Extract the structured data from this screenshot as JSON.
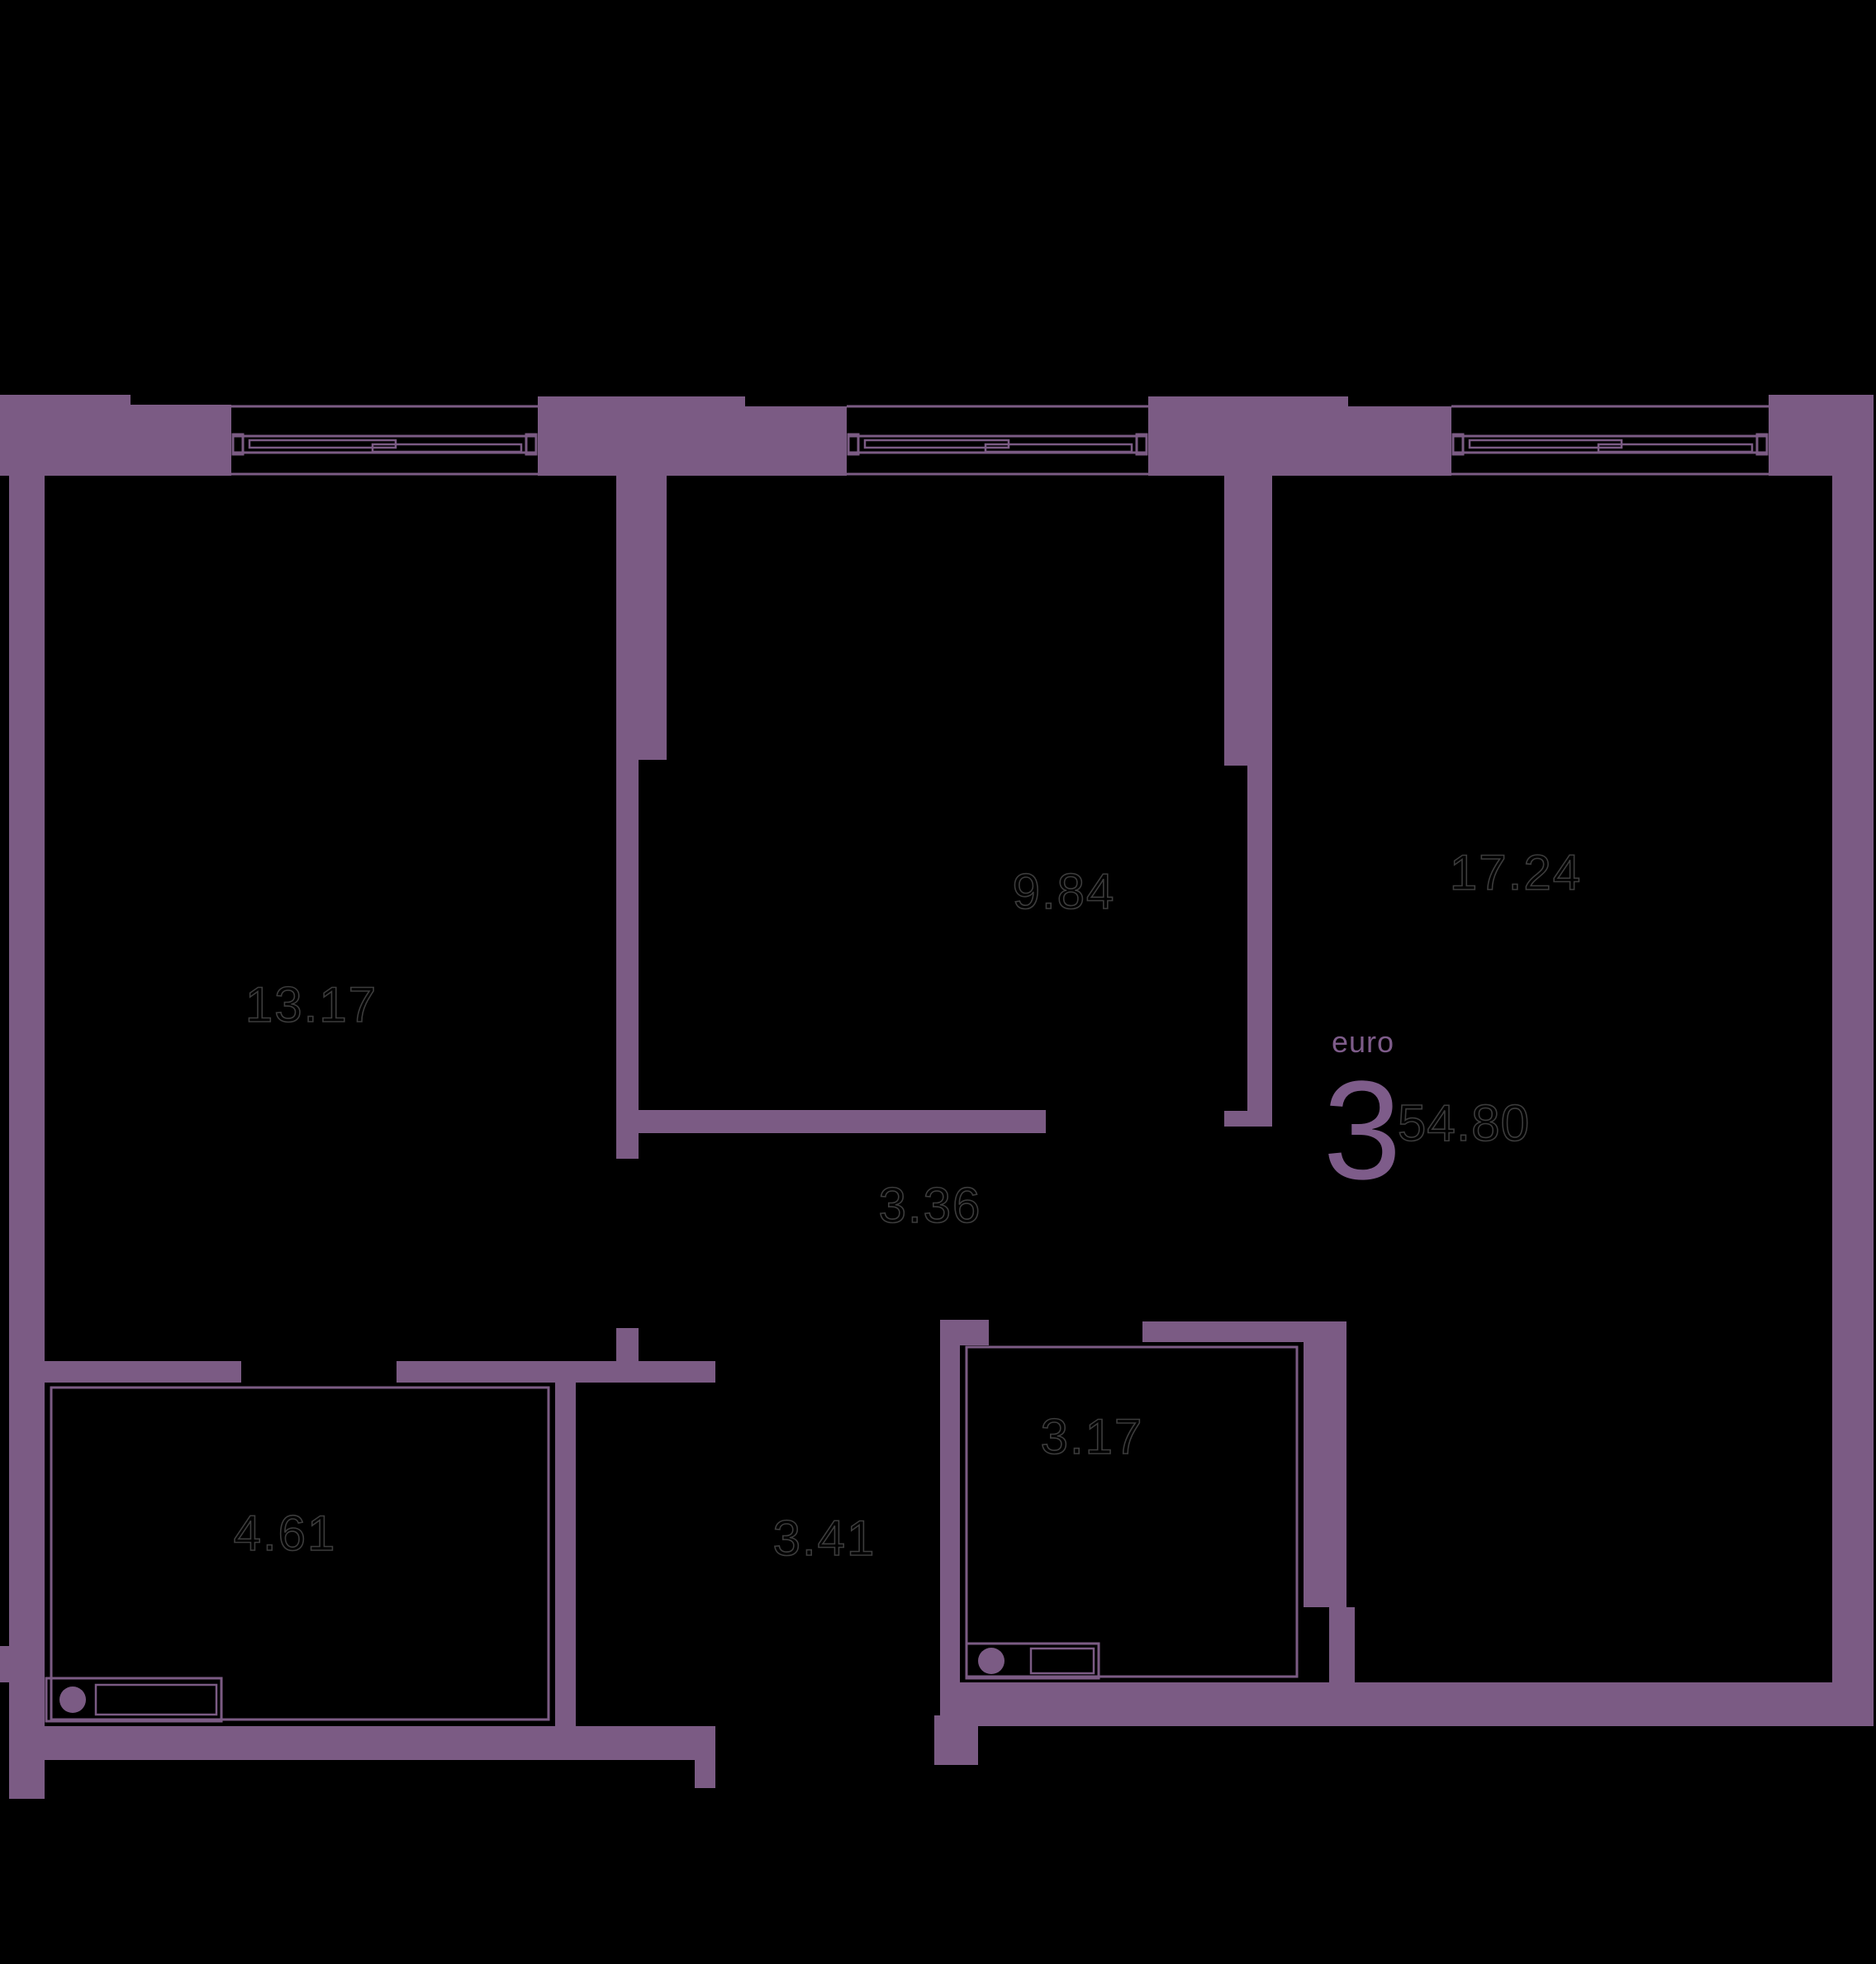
{
  "unit": {
    "type_label": "euro",
    "rooms_count": "3",
    "total_area": "54.80"
  },
  "rooms": [
    {
      "id": "living-room",
      "area": "13.17"
    },
    {
      "id": "bedroom-middle",
      "area": "9.84"
    },
    {
      "id": "bedroom-right",
      "area": "17.24"
    },
    {
      "id": "corridor",
      "area": "3.36"
    },
    {
      "id": "bathroom",
      "area": "4.61"
    },
    {
      "id": "hallway",
      "area": "3.41"
    },
    {
      "id": "wc",
      "area": "3.17"
    }
  ],
  "colors": {
    "background": "#000000",
    "wall": "#7B5B84",
    "accent_text": "#7E5C8A",
    "area_label_stroke": "#3C3C3C"
  }
}
